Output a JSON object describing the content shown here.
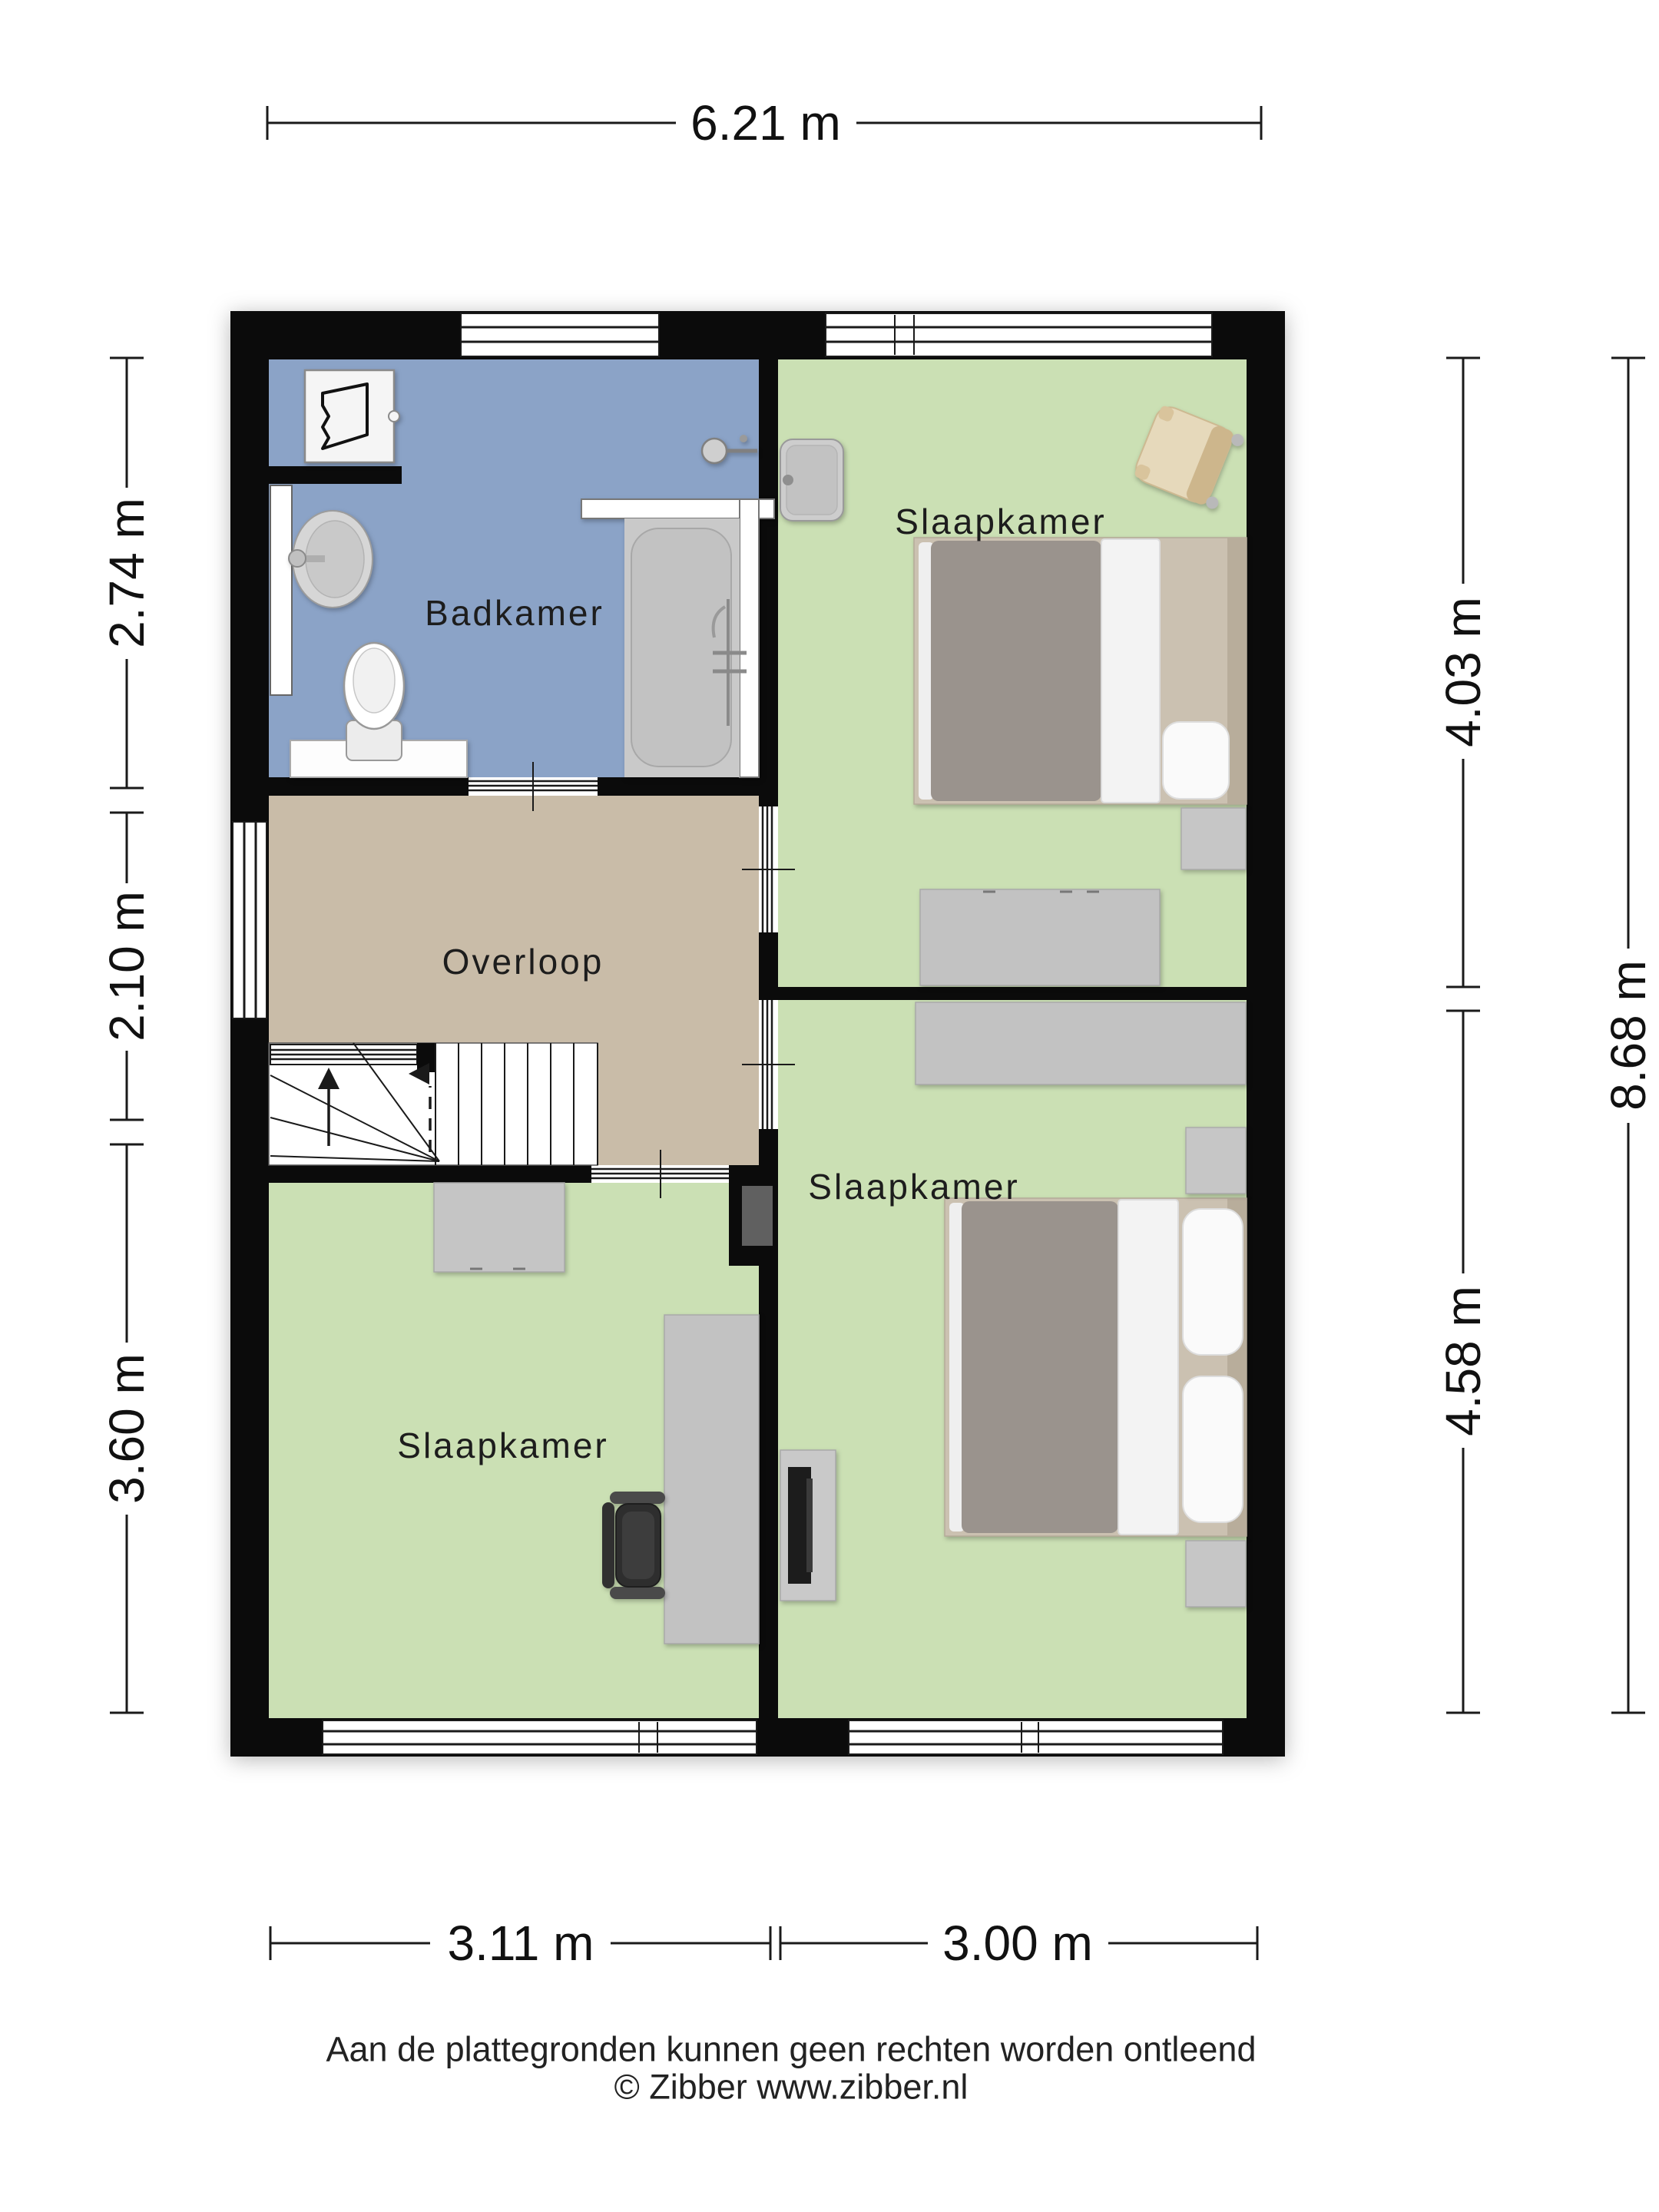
{
  "plan": {
    "colors": {
      "wall": "#0b0b0b",
      "bathroom_floor": "#8ba3c7",
      "bedroom_floor": "#cbe0b4",
      "landing_floor": "#c9bca8",
      "furniture_grey": "#c2c2c2",
      "bed_duvet": "#9a938d",
      "bed_frame": "#cbc1b1",
      "wicker_chair": "#e6d9bb"
    },
    "rooms": [
      {
        "id": "badkamer",
        "label": "Badkamer"
      },
      {
        "id": "slaapkamer-rechtsboven",
        "label": "Slaapkamer"
      },
      {
        "id": "overloop",
        "label": "Overloop"
      },
      {
        "id": "slaapkamer-linksonder",
        "label": "Slaapkamer"
      },
      {
        "id": "slaapkamer-rechtsonder",
        "label": "Slaapkamer"
      }
    ],
    "fixtures": [
      "washing-machine",
      "wall-sink",
      "toilet",
      "bathtub",
      "shower-mixer",
      "wash-basin",
      "wicker-chair",
      "double-bed",
      "nightstand",
      "desk",
      "office-chair",
      "dresser",
      "tv-cabinet",
      "stairs",
      "chimney-duct"
    ]
  },
  "dimensions": {
    "top": "6.21 m",
    "bottom_left": "3.11 m",
    "bottom_right": "3.00 m",
    "left_top": "2.74 m",
    "left_middle": "2.10 m",
    "left_bottom": "3.60 m",
    "right_top": "4.03 m",
    "right_bottom": "4.58 m",
    "right_total": "8.68 m"
  },
  "footer": {
    "disclaimer": "Aan de plattegronden kunnen geen rechten worden ontleend",
    "copyright": "© Zibber www.zibber.nl"
  }
}
